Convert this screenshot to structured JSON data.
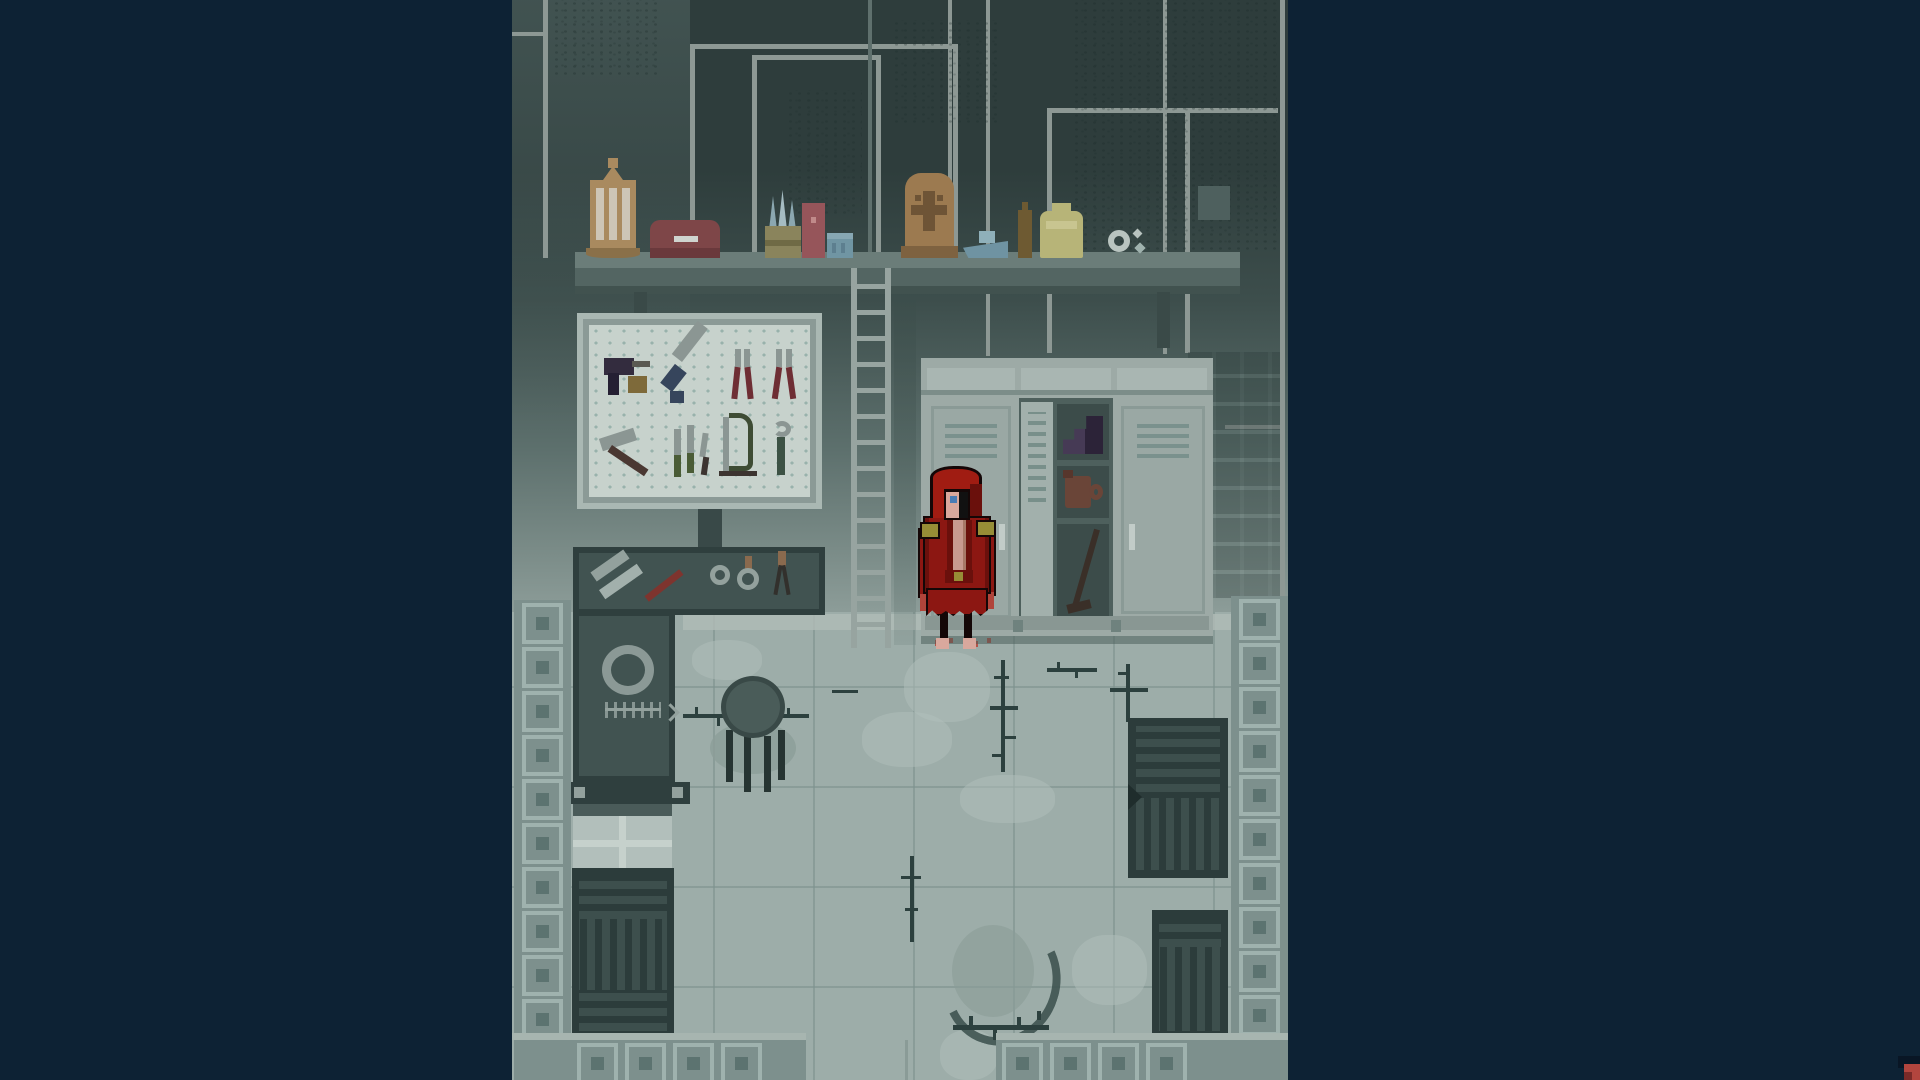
{
  "app": {
    "type": "pixel-art adventure game",
    "view": "side-view room scene, letterboxed on navy background",
    "ui_text_visible": false
  },
  "palette": {
    "bg_navy": "#0d2234",
    "corner_red": "#b2453e",
    "corner_red_dark": "#7a2a28",
    "corner_navy": "#091625",
    "wall_dark": "#2e3d3c",
    "wall_mid": "#5d706d",
    "wall_light": "#8e9e9a",
    "wall_left": "#465856",
    "pipe": "#8d9894",
    "pipe_dark": "#5f706d",
    "grunge": "#273534",
    "shelf_top": "#6b7d79",
    "shelf_face": "#536562",
    "shelf_edge": "#41524f",
    "board_frame": "#8b9a96",
    "board_face": "#aab8b3",
    "board_panel": "#c7d2cc",
    "ladder": "#97a4a0",
    "locker_body": "#9daaa6",
    "locker_cap": "#a9b6b2",
    "locker_vent": "#7a918d",
    "locker_dark": "#4e605d",
    "locker_inner": "#3c4c4a",
    "locker_base": "#899793",
    "floor": "#9dada9",
    "floor_light": "#b2c0bb",
    "grout": "#8a9b97",
    "scratch": "#2c403e",
    "stain": "#8b9c98",
    "stain_dark": "#3a4f4c",
    "bench": "#415351",
    "bench_dark": "#2f3f3e",
    "bench_item": "#93a19d",
    "knife_red": "#7e342e",
    "tile_col": "#7d908d",
    "tile_light": "#9fb2ae",
    "tile_dark": "#5c7370",
    "crate": "#2c3c3b",
    "crate_slat": "#3d4f4d",
    "hood_red": "#a01c12",
    "robe_red": "#8c1712",
    "robe_dark": "#6a100c",
    "outline_black": "#140707",
    "skin": "#d9a89d",
    "skin_light": "#ecd0c4",
    "eye_blue": "#4a7cb5",
    "gold": "#978d36",
    "chest": "#c89a90",
    "blood": "#b35248",
    "lantern": "#a98a5f",
    "lantern_panel": "#cdc5b6",
    "maroon": "#7e4648",
    "jar_olive": "#8a845c",
    "brush_blue": "#8ba7b0",
    "box_red": "#96555a",
    "tin_blue": "#7095a3",
    "birdhouse": "#9c7a50",
    "birdhouse_dark": "#6e5436",
    "boat_blue": "#6f93a2",
    "bottle_olive": "#6e5a32",
    "jar_yellow": "#b7b478",
    "boot_purple": "#463a55",
    "boot_purple_dark": "#2c2338",
    "jug_brown": "#6a4538",
    "crowbar": "#3a2f28",
    "tool_dark": "#332c3e",
    "tool_gray": "#8b9693",
    "tool_blue": "#36455c",
    "tool_redhandle": "#6e2e34",
    "tool_green": "#4a5c36",
    "tool_brown": "#7e6a3a",
    "wood_brown": "#4a3832"
  },
  "scene": {
    "room": "workshop storage basement",
    "wall_features": [
      "panel pipes",
      "nested door frames",
      "grime patches",
      "dark wall grid right of lockers"
    ],
    "shelf": {
      "items": [
        "hanging lantern",
        "maroon case",
        "jar with brushes",
        "red box",
        "blue tin",
        "carved birdhouse",
        "toy boat",
        "small bottle",
        "yellow jar",
        "gear trinket"
      ]
    },
    "tool_board": {
      "tools": [
        "power drill",
        "handsaw",
        "pliers",
        "pliers",
        "hammer",
        "chisel set",
        "hacksaw",
        "wrench"
      ]
    },
    "ladder": {
      "rungs": 14
    },
    "lockers": {
      "units": 3,
      "left": "closed vented door with handle",
      "middle": "open, narrow door ajar",
      "right": "closed vented door with handle",
      "middle_contents": [
        "stack of purple boots",
        "brown jug",
        "crowbar"
      ]
    },
    "character": {
      "description": "pale-faced figure in ragged red hooded robe",
      "eye_color": "blue",
      "shoulder_trim": "gold epaulettes",
      "legs": "thin black legs, bare feet",
      "floor_marks": "small blood drips at feet"
    },
    "workbench": {
      "shape": "L-shaped, top-down",
      "surface_items": [
        "metal files",
        "red-handled knife",
        "washer",
        "hand mirror",
        "scissors",
        "large ring",
        "fishbone scratches"
      ]
    },
    "stool": {
      "legs": 4
    },
    "floor_marks": [
      "claw scratches",
      "dust patches",
      "dark stain ring",
      "blood drips"
    ],
    "crates": [
      "slatted crate bottom-left",
      "slatted pallet right",
      "slatted crate bottom-right"
    ],
    "borders": {
      "pattern": "concentric-square tiles",
      "left_tiles": 10,
      "right_tiles": 10,
      "bottom_left_tiles": 4,
      "bottom_right_tiles": 4,
      "exit_gap": "opening in bottom tile border, centre"
    },
    "overlay": {
      "corner_marker": "small red block at bottom-right screen corner"
    }
  }
}
